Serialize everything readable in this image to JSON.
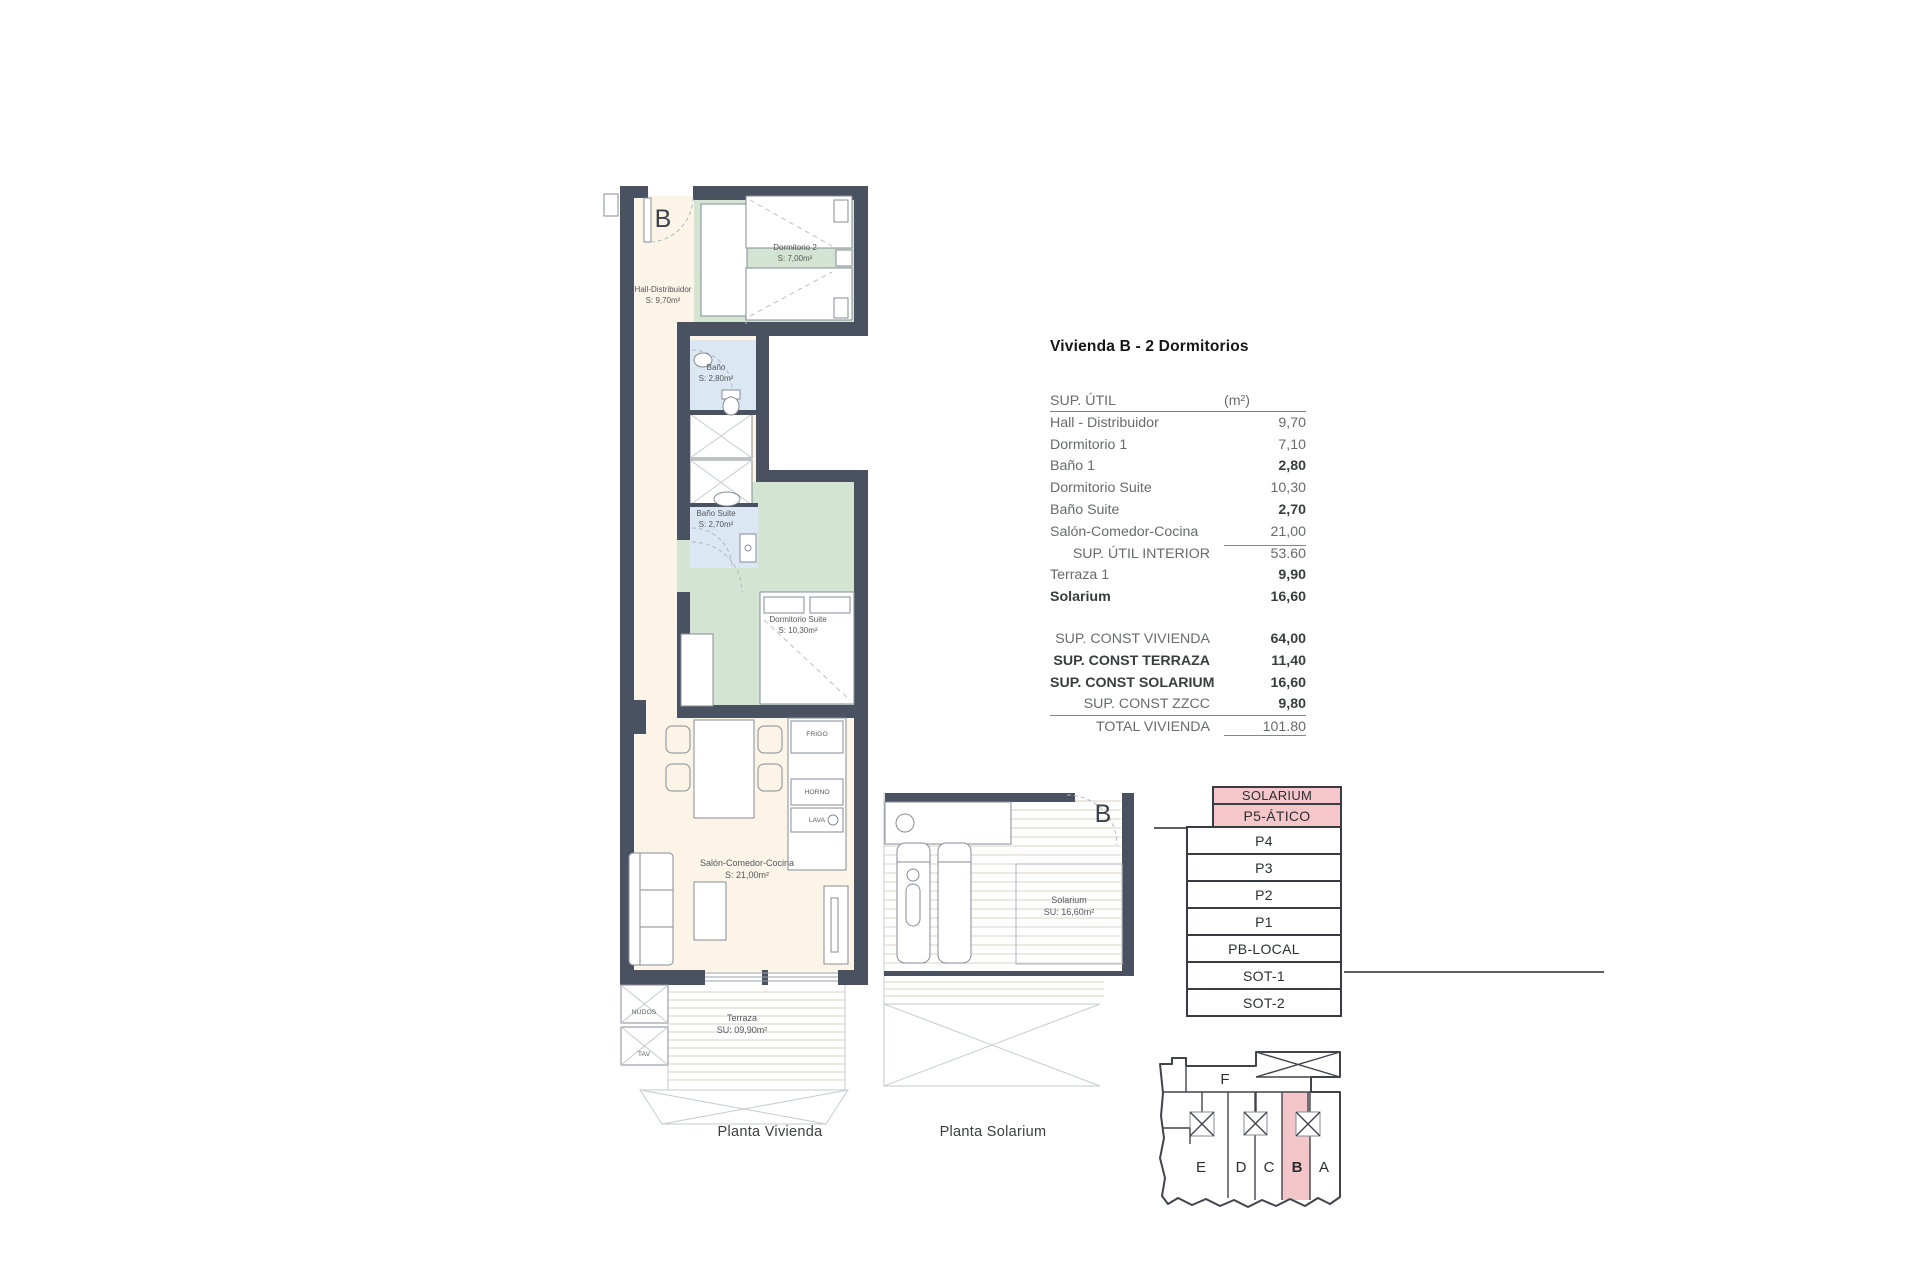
{
  "sheet": {
    "captions": {
      "vivienda": "Planta Vivienda",
      "solarium": "Planta Solarium"
    }
  },
  "summary": {
    "title": "Vivienda B - 2 Dormitorios",
    "header": {
      "label": "SUP. ÚTIL",
      "unit": "(m²)"
    },
    "rows": [
      {
        "label": "Hall - Distribuidor",
        "value": "9,70"
      },
      {
        "label": "Dormitorio 1",
        "value": "7,10"
      },
      {
        "label": "Baño 1",
        "value": "2,80"
      },
      {
        "label": "Dormitorio Suite",
        "value": "10,30"
      },
      {
        "label": "Baño Suite",
        "value": "2,70"
      },
      {
        "label": "Salón-Comedor-Cocina",
        "value": "21,00"
      },
      {
        "label": "SUP. ÚTIL INTERIOR",
        "value": "53.60"
      },
      {
        "label": "Terraza 1",
        "value": "9,90"
      },
      {
        "label": "Solarium",
        "value": "16,60"
      }
    ],
    "const_rows": [
      {
        "label": "SUP. CONST VIVIENDA",
        "value": "64,00"
      },
      {
        "label": "SUP. CONST TERRAZA",
        "value": "11,40"
      },
      {
        "label": "SUP. CONST SOLARIUM",
        "value": "16,60"
      },
      {
        "label": "SUP. CONST ZZCC",
        "value": "9,80"
      }
    ],
    "total": {
      "label": "TOTAL VIVIENDA",
      "value": "101.80"
    }
  },
  "plan": {
    "unit_letter": "B",
    "rooms": {
      "hall": {
        "name": "Hall-Distribuidor",
        "area": "S: 9,70m²"
      },
      "dormitorio2": {
        "name": "Dormitorio 2",
        "area": "S: 7,00m²"
      },
      "bano": {
        "name": "Baño",
        "area": "S: 2,80m²"
      },
      "bano_suite": {
        "name": "Baño Suite",
        "area": "S: 2,70m²"
      },
      "dormitorio_suite": {
        "name": "Dormitorio Suite",
        "area": "S: 10,30m²"
      },
      "salon": {
        "name": "Salón-Comedor-Cocina",
        "area": "S: 21,00m²"
      },
      "terraza": {
        "name": "Terraza",
        "area": "SU: 09,90m²"
      }
    },
    "appliances": {
      "fridge": "FRIGO",
      "oven": "HORNO",
      "sink": "LAVA"
    },
    "shafts": {
      "top": "NUDOS",
      "bottom": "TAV"
    }
  },
  "solarium_plan": {
    "unit_letter": "B",
    "room_name": "Solarium",
    "room_area": "SU: 16,60m²"
  },
  "floor_stack": {
    "floors": [
      "SOLARIUM",
      "P5-ÁTICO",
      "P4",
      "P3",
      "P2",
      "P1",
      "PB-LOCAL",
      "SOT-1",
      "SOT-2"
    ],
    "highlighted_floors": [
      "SOLARIUM",
      "P5-ÁTICO"
    ]
  },
  "footprint": {
    "top_unit": "F",
    "units": [
      "E",
      "D",
      "C",
      "B",
      "A"
    ],
    "highlighted_unit": "B"
  },
  "colors": {
    "wall": "#4a5261",
    "floor_cream": "#fbf4e7",
    "bedroom_green": "#d3e4d2",
    "bathroom_blue": "#dbe7f2",
    "highlight_pink": "#f5c6ca"
  }
}
